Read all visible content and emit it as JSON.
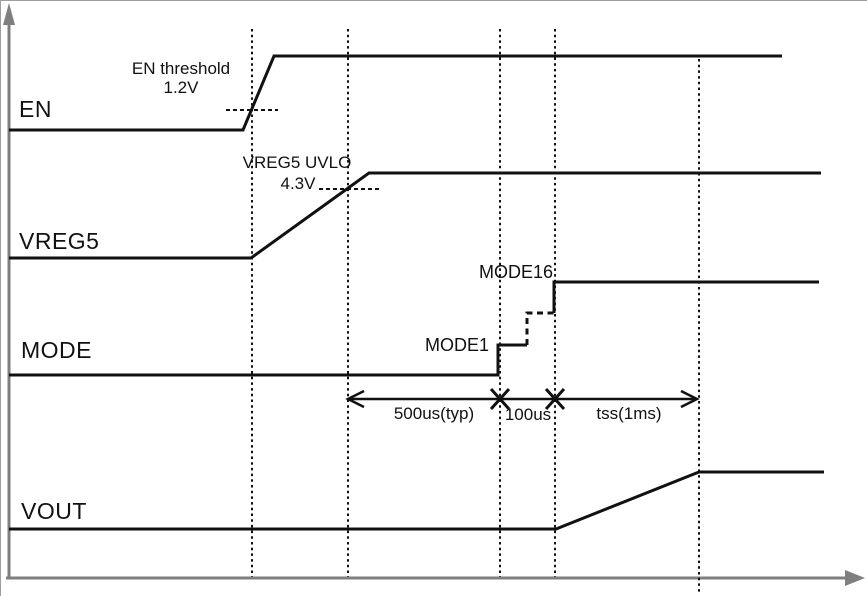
{
  "figure": {
    "type": "timing-diagram",
    "colors": {
      "background": "#ffffff",
      "axis": "#7f7f7f",
      "signal": "#111111",
      "text": "#111111"
    },
    "axes": {
      "v_x": 8,
      "v_y_top": 18,
      "h_y": 577,
      "h_x_start": 5,
      "h_x_end": 864
    },
    "signals": [
      {
        "label": "EN",
        "points": [
          [
            8,
            129
          ],
          [
            242,
            129
          ],
          [
            273,
            55
          ],
          [
            781,
            55
          ]
        ]
      },
      {
        "label": "VREG5",
        "points": [
          [
            8,
            257
          ],
          [
            250,
            257
          ],
          [
            368,
            172
          ],
          [
            820,
            172
          ]
        ]
      },
      {
        "label": "MODE",
        "segments": [
          {
            "style": "solid",
            "points": [
              [
                8,
                374
              ],
              [
                497,
                374
              ],
              [
                497,
                344
              ],
              [
                526,
                344
              ]
            ]
          },
          {
            "style": "dashed",
            "points": [
              [
                526,
                344
              ],
              [
                526,
                312
              ],
              [
                553,
                312
              ]
            ]
          },
          {
            "style": "solid",
            "points": [
              [
                553,
                312
              ],
              [
                553,
                281
              ],
              [
                818,
                281
              ]
            ]
          }
        ]
      },
      {
        "label": "VOUT",
        "points": [
          [
            8,
            528
          ],
          [
            555,
            528
          ],
          [
            698,
            471
          ],
          [
            823,
            471
          ]
        ]
      }
    ],
    "event_lines": [
      {
        "x": 251,
        "y1": 28,
        "y2": 576
      },
      {
        "x": 347,
        "y1": 28,
        "y2": 576
      },
      {
        "x": 499,
        "y1": 28,
        "y2": 576
      },
      {
        "x": 554,
        "y1": 28,
        "y2": 576
      },
      {
        "x": 698,
        "y1": 58,
        "y2": 593
      }
    ],
    "thresholds": [
      {
        "label_line1": "EN threshold",
        "label_line2": "1.2V",
        "dash": {
          "x1": 225,
          "x2": 277,
          "y": 109
        }
      },
      {
        "label_line1": "VREG5 UVLO",
        "label_line2": "4.3V",
        "dash": {
          "x1": 318,
          "x2": 380,
          "y": 188
        }
      }
    ],
    "step_labels": [
      {
        "text": "MODE1"
      },
      {
        "text": "MODE16"
      }
    ],
    "time_spans": {
      "arrow_y": 398,
      "x_start": 347,
      "x_end": 696,
      "cross_marks": [
        499,
        554
      ],
      "labels": [
        {
          "text": "500us(typ)"
        },
        {
          "text": "100us"
        },
        {
          "text": "tss(1ms)"
        }
      ]
    }
  }
}
